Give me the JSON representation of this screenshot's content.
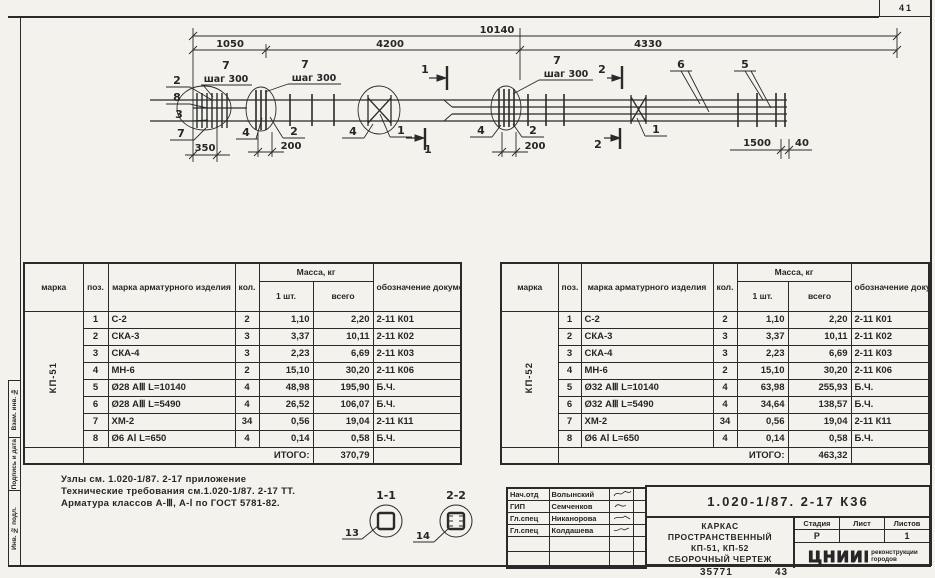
{
  "sheet": {
    "corner_number": "41",
    "footer_left": "35771",
    "footer_right": "43"
  },
  "strip": {
    "cells": [
      "Взам. инв. №",
      "Подпись и дата",
      "Инв. № подл."
    ]
  },
  "drawing": {
    "dim_overall": "10140",
    "dim_seg1": "1050",
    "dim_seg2": "4200",
    "dim_seg3": "4330",
    "dim_350": "350",
    "dim_200": "200",
    "dim_1500": "1500",
    "dim_40": "40",
    "pitch": "шаг 300",
    "pos1": "1",
    "pos2": "2",
    "pos3": "3",
    "pos4": "4",
    "pos5": "5",
    "pos6": "6",
    "pos7": "7",
    "pos8": "8",
    "sec1": "1",
    "sec2": "2",
    "detail1": "1-1",
    "detail2": "2-2",
    "detail1_pos": "13",
    "detail2_pos": "14"
  },
  "notes": {
    "line1": "Узлы см. 1.020-1/87. 2-17 приложение",
    "line2": "Технические требования см.1.020-1/87. 2-17 ТТ.",
    "line3": "Арматура классов А-Ⅲ, А-Ⅰ по ГОСТ 5781-82."
  },
  "table_headers": {
    "marka": "марка",
    "poz": "поз.",
    "izdelie": "марка арматурного изделия",
    "kol": "кол.",
    "massa": "Масса, кг",
    "one": "1 шт.",
    "total": "всего",
    "doc": "обозначение документа",
    "itogo": "ИТОГО:"
  },
  "table_left": {
    "mark": "КП-51",
    "total": "370,79",
    "rows": [
      {
        "poz": "1",
        "name": "С-2",
        "kol": "2",
        "one": "1,10",
        "total": "2,20",
        "doc": "2-11 К01"
      },
      {
        "poz": "2",
        "name": "СКА-3",
        "kol": "3",
        "one": "3,37",
        "total": "10,11",
        "doc": "2-11 К02"
      },
      {
        "poz": "3",
        "name": "СКА-4",
        "kol": "3",
        "one": "2,23",
        "total": "6,69",
        "doc": "2-11 К03"
      },
      {
        "poz": "4",
        "name": "МН-6",
        "kol": "2",
        "one": "15,10",
        "total": "30,20",
        "doc": "2-11 К06"
      },
      {
        "poz": "5",
        "name": "Ø28 АⅢ L=10140",
        "kol": "4",
        "one": "48,98",
        "total": "195,90",
        "doc": "Б.Ч."
      },
      {
        "poz": "6",
        "name": "Ø28 АⅢ L=5490",
        "kol": "4",
        "one": "26,52",
        "total": "106,07",
        "doc": "Б.Ч."
      },
      {
        "poz": "7",
        "name": "ХМ-2",
        "kol": "34",
        "one": "0,56",
        "total": "19,04",
        "doc": "2-11 К11"
      },
      {
        "poz": "8",
        "name": "Ø6 АⅠ L=650",
        "kol": "4",
        "one": "0,14",
        "total": "0,58",
        "doc": "Б.Ч."
      }
    ]
  },
  "table_right": {
    "mark": "КП-52",
    "total": "463,32",
    "rows": [
      {
        "poz": "1",
        "name": "С-2",
        "kol": "2",
        "one": "1,10",
        "total": "2,20",
        "doc": "2-11 К01"
      },
      {
        "poz": "2",
        "name": "СКА-3",
        "kol": "3",
        "one": "3,37",
        "total": "10,11",
        "doc": "2-11 К02"
      },
      {
        "poz": "3",
        "name": "СКА-4",
        "kol": "3",
        "one": "2,23",
        "total": "6,69",
        "doc": "2-11 К03"
      },
      {
        "poz": "4",
        "name": "МН-6",
        "kol": "2",
        "one": "15,10",
        "total": "30,20",
        "doc": "2-11 К06"
      },
      {
        "poz": "5",
        "name": "Ø32 АⅢ L=10140",
        "kol": "4",
        "one": "63,98",
        "total": "255,93",
        "doc": "Б.Ч."
      },
      {
        "poz": "6",
        "name": "Ø32 АⅢ L=5490",
        "kol": "4",
        "one": "34,64",
        "total": "138,57",
        "doc": "Б.Ч."
      },
      {
        "poz": "7",
        "name": "ХМ-2",
        "kol": "34",
        "one": "0,56",
        "total": "19,04",
        "doc": "2-11 К11"
      },
      {
        "poz": "8",
        "name": "Ø6 АⅠ L=650",
        "kol": "4",
        "one": "0,14",
        "total": "0,58",
        "doc": "Б.Ч."
      }
    ]
  },
  "titleblock": {
    "doc_number": "1.020-1/87. 2-17  К36",
    "title1": "КАРКАС",
    "title2": "ПРОСТРАНСТВЕННЫЙ",
    "title3": "КП-51, КП-52",
    "title4": "СБОРОЧНЫЙ ЧЕРТЕЖ",
    "stage_label": "Стадия",
    "sheet_label": "Лист",
    "sheets_label": "Листов",
    "stage": "Р",
    "sheet": "",
    "sheets": "1",
    "org": "ЦНИИП",
    "org_sub1": "реконструкции",
    "org_sub2": "городов",
    "signers": [
      {
        "role": "Нач.отд",
        "name": "Волынский"
      },
      {
        "role": "ГИП",
        "name": "Семченков"
      },
      {
        "role": "Гл.спец",
        "name": "Никанорова"
      },
      {
        "role": "Гл.спец",
        "name": "Колдашева"
      }
    ]
  }
}
